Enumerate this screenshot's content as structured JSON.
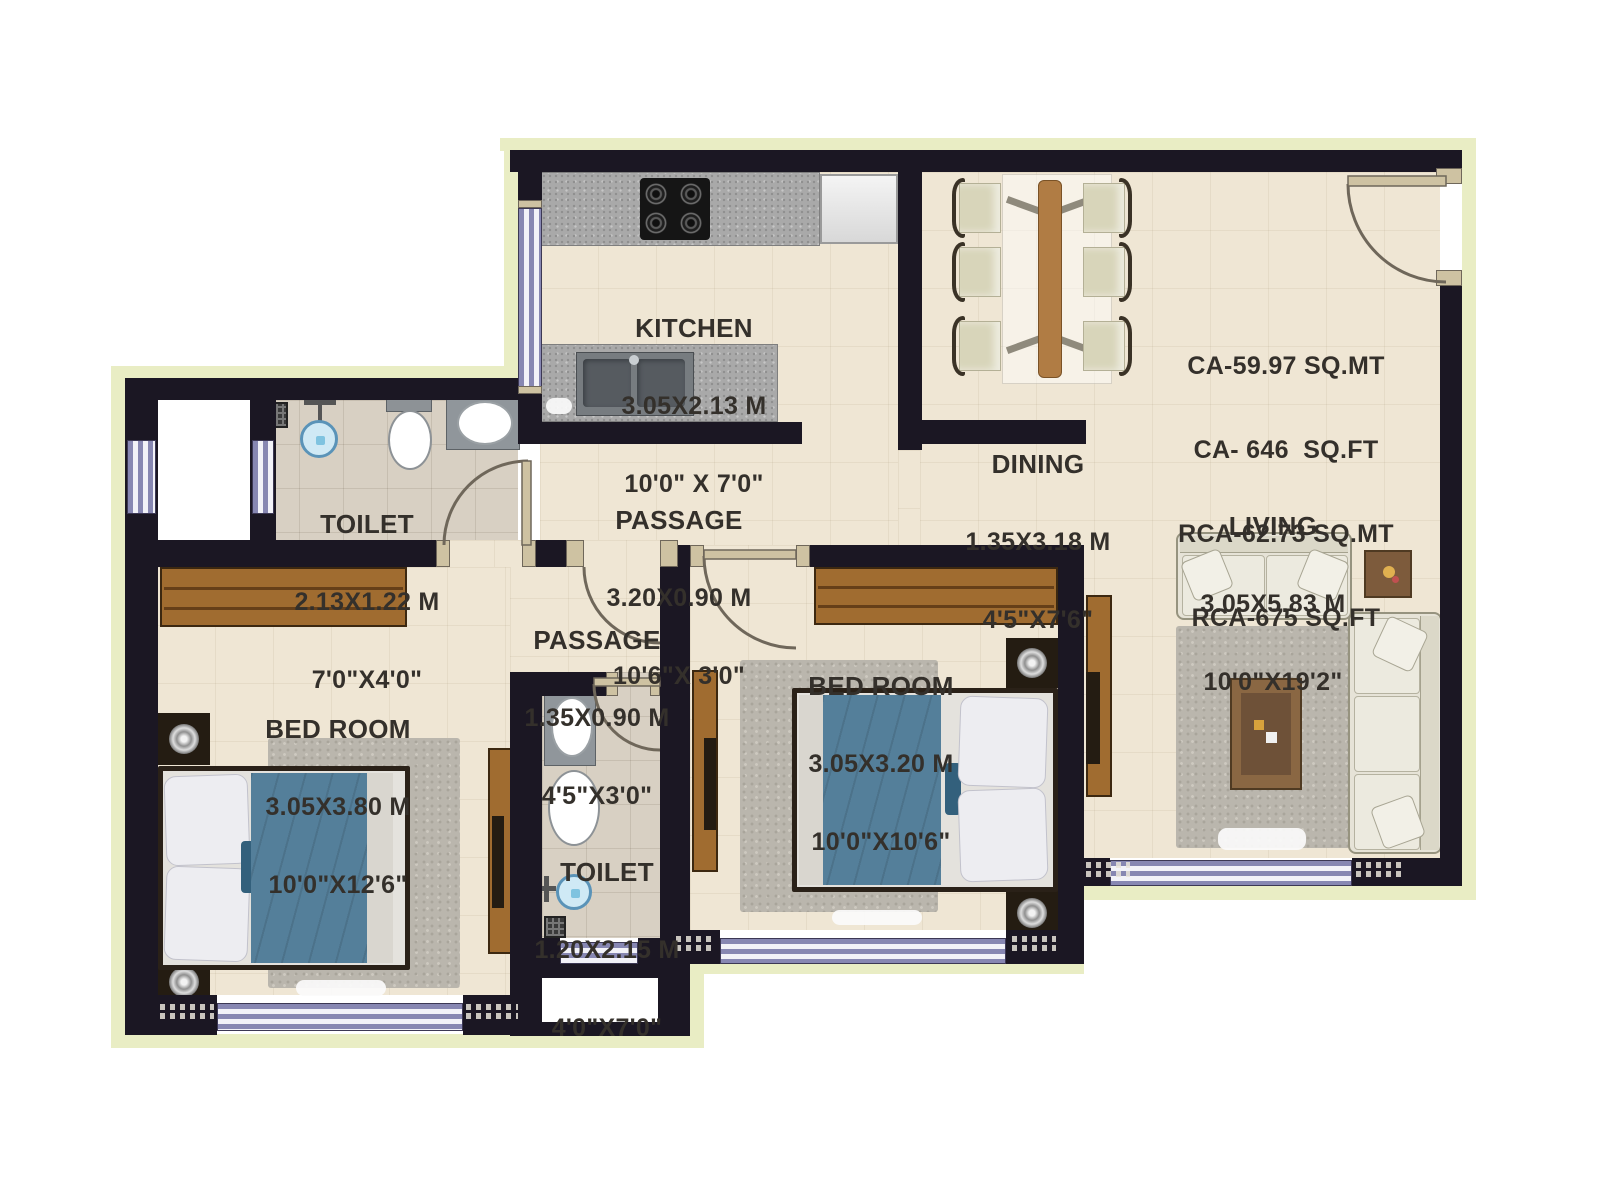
{
  "rooms": {
    "kitchen": {
      "name": "KITCHEN",
      "metric": "3.05X2.13 M",
      "imperial": "10'0\" X 7'0\""
    },
    "dining": {
      "name": "DINING",
      "metric": "1.35X3.18 M",
      "imperial": "4'5\"X7'6\""
    },
    "living": {
      "name": "LIVING",
      "metric": "3.05X5.83 M",
      "imperial": "10'0\"X19'2\""
    },
    "toilet_top": {
      "name": "TOILET",
      "metric": "2.13X1.22 M",
      "imperial": "7'0\"X4'0\""
    },
    "passage_main": {
      "name": "PASSAGE",
      "metric": "3.20X0.90 M",
      "imperial": "10'6\"X 3'0\""
    },
    "passage_small": {
      "name": "PASSAGE",
      "metric": "1.35X0.90 M",
      "imperial": "4'5\"X3'0\""
    },
    "bedroom_left": {
      "name": "BED ROOM",
      "metric": "3.05X3.80 M",
      "imperial": "10'0\"X12'6\""
    },
    "toilet_middle": {
      "name": "TOILET",
      "metric": "1.20X2.15 M",
      "imperial": "4'0\"X7'0\""
    },
    "bedroom_right": {
      "name": "BED ROOM",
      "metric": "3.05X3.20 M",
      "imperial": "10'0\"X10'6\""
    }
  },
  "area_summary": {
    "ca_mt": "CA-59.97 SQ.MT",
    "ca_ft": "CA- 646  SQ.FT",
    "rca_mt": "RCA-62.73 SQ.MT",
    "rca_ft": "RCA-675 SQ.FT"
  },
  "colors": {
    "wall": "#1b1723",
    "floor_cream": "#efe6d4",
    "floor_tile": "#d8d0c3",
    "window_stripe": "#8787b2",
    "wood": "#a06c30",
    "duvet_blue": "#547f9a",
    "plan_outline": "#e9edc4",
    "label_text": "#34302b"
  }
}
